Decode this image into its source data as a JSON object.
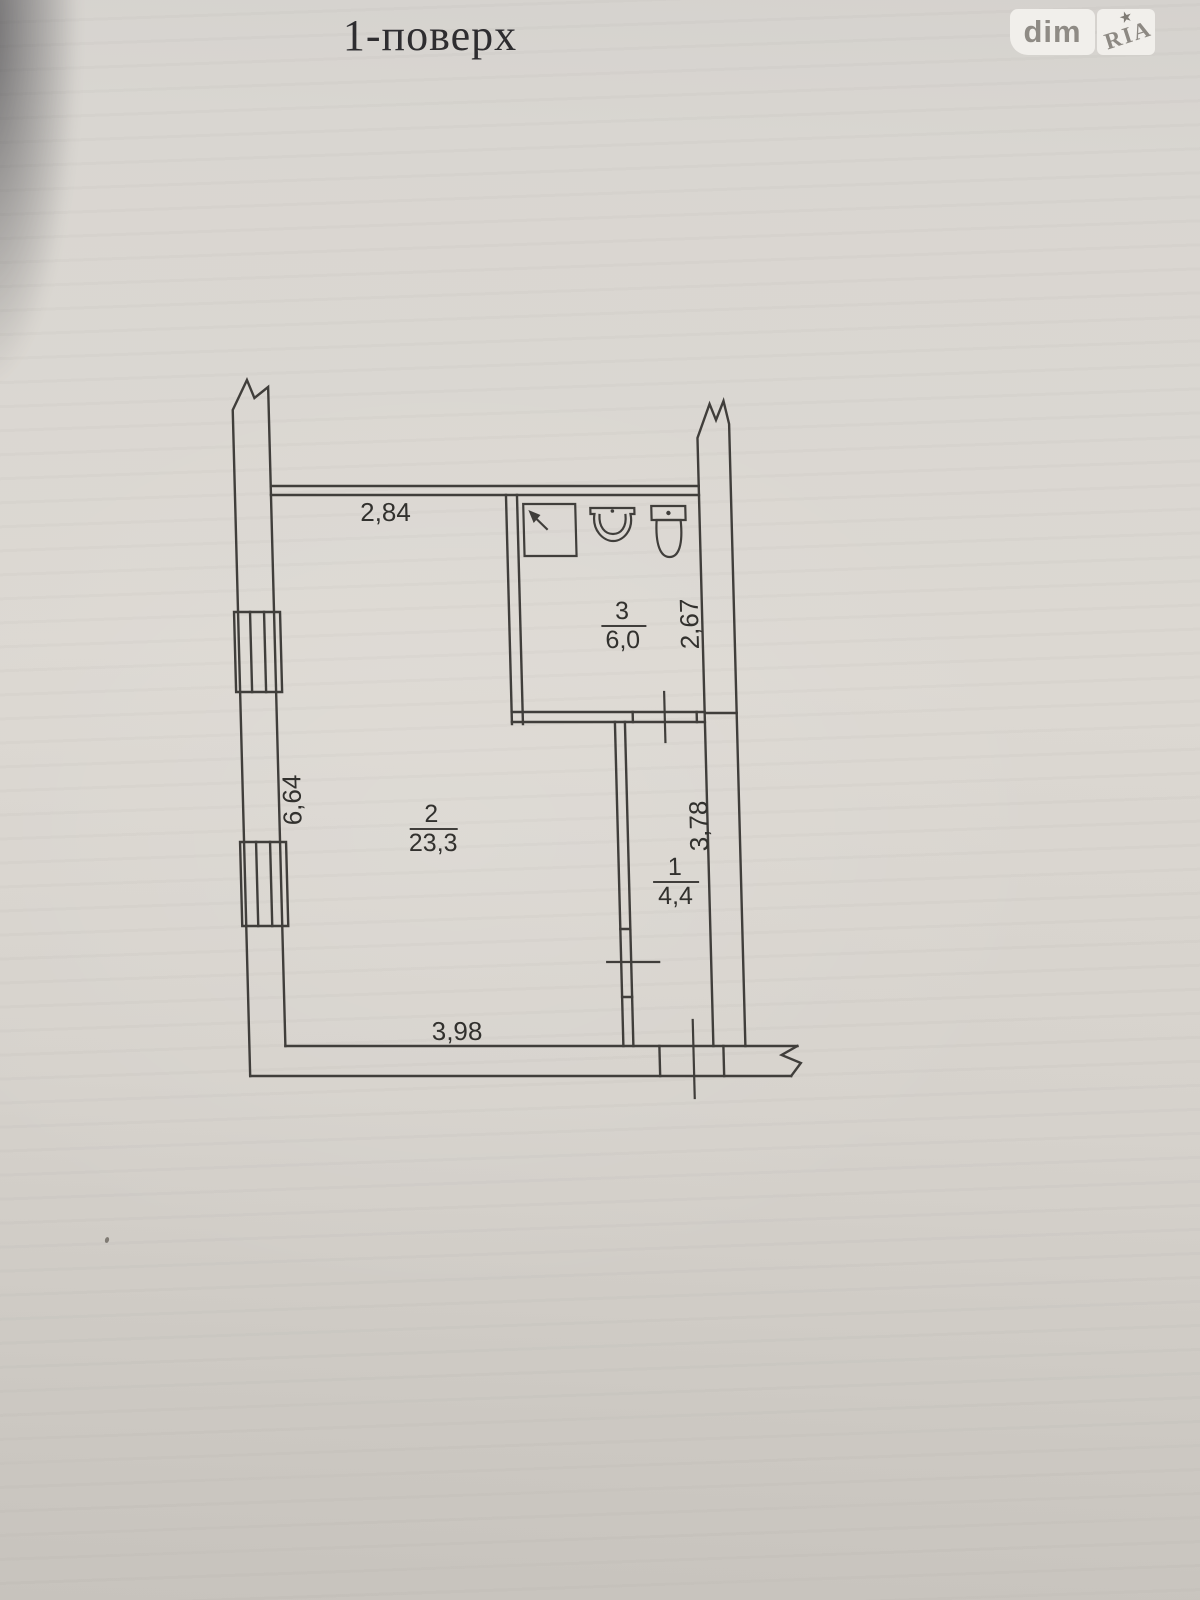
{
  "page": {
    "title": "1-поверх",
    "paper_color": "#d9d6d1",
    "line_color": "#403e3b"
  },
  "logo": {
    "left_text": "dim",
    "right_text": "RIA",
    "star_glyph": "★",
    "box_color": "#f1efeb",
    "text_color": "#8f8b85"
  },
  "floor_plan": {
    "floor_label": "1-поверх",
    "rooms": [
      {
        "number": "2",
        "area": "23,3",
        "name": "main-room"
      },
      {
        "number": "3",
        "area": "6,0",
        "name": "bathroom"
      },
      {
        "number": "1",
        "area": "4,4",
        "name": "corridor"
      }
    ],
    "dimensions": {
      "top_wall": "2,84",
      "left_wall": "6,64",
      "bathroom_right_wall": "2,67",
      "corridor_right_wall": "3,78",
      "bottom_wall": "3,98"
    },
    "fixtures": [
      "shower-icon",
      "sink-icon",
      "toilet-icon"
    ]
  }
}
